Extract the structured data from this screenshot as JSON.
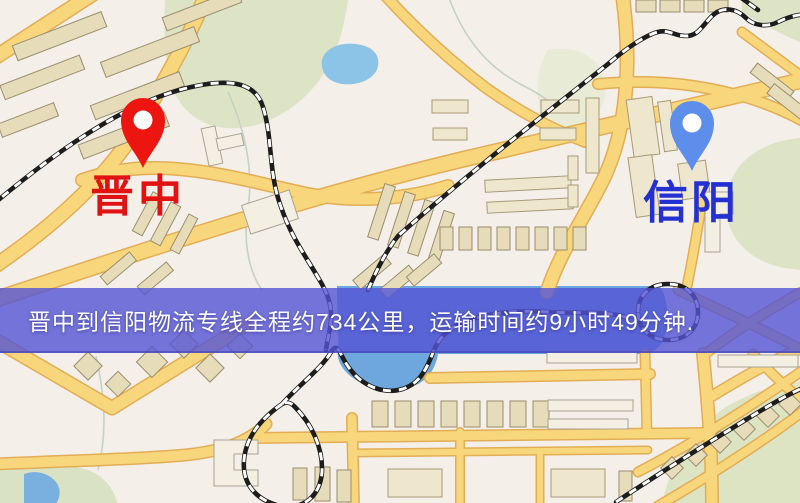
{
  "map": {
    "origin_marker": {
      "label": "晋中",
      "pin_color": "#ed1510",
      "label_color": "#e01212"
    },
    "destination_marker": {
      "label": "信阳",
      "pin_color": "#5e8eeb",
      "label_color": "#2430d2"
    },
    "caption": {
      "text": "晋中到信阳物流专线全程约734公里，运输时间约9小时49分钟.",
      "bar_color": "rgba(84,84,212,0.8)",
      "text_color": "#ffffff"
    },
    "legend_colors": {
      "road": "#f8d77c",
      "railway": "#1d1d1d",
      "park": "#dde4c6",
      "water": "#6ea7dd",
      "building": "#e7dcba"
    }
  }
}
